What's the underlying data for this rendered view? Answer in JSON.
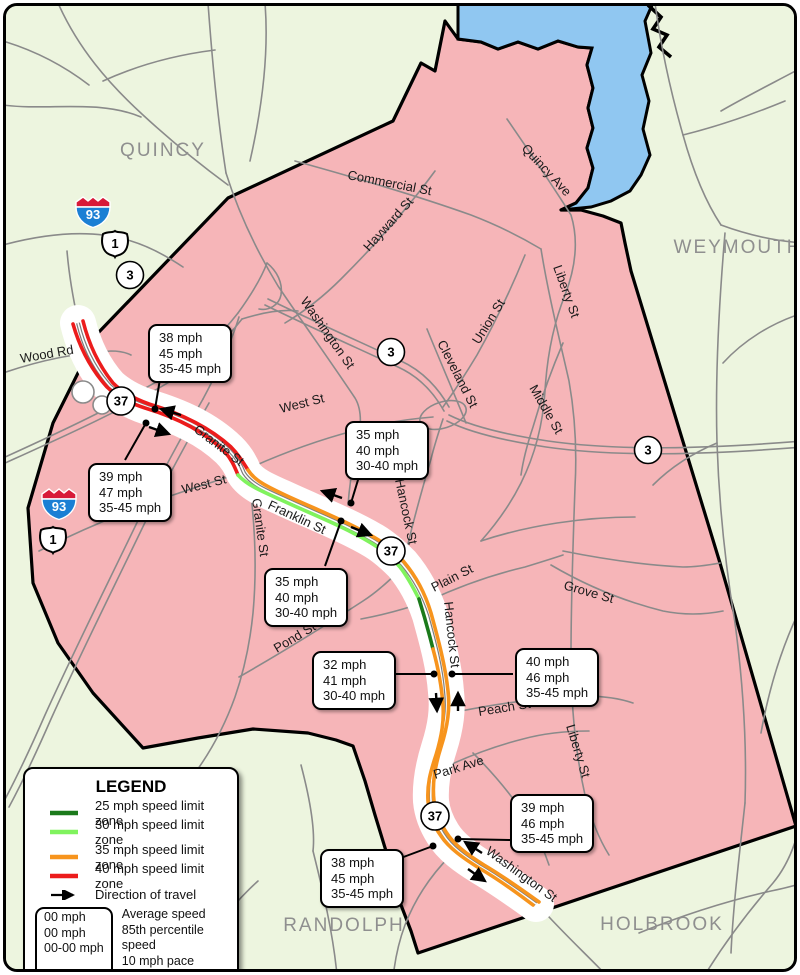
{
  "colors": {
    "zone25": "#1b7a1b",
    "zone30": "#80f35e",
    "zone35": "#f7941d",
    "zone40": "#ec1c1c",
    "town_fill": "#f6b5b8",
    "neighbor_fill": "#edf5df",
    "water": "#90c7f1",
    "road": "#8a8a8a",
    "town_label": "#8f8f8f"
  },
  "map": {
    "towns": {
      "quincy": "QUINCY",
      "weymouth": "WEYMOUTH",
      "randolph": "RANDOLPH",
      "holbrook": "HOLBROOK"
    },
    "shields": {
      "i93": "93",
      "us1": "1",
      "r3": "3",
      "r37": "37"
    },
    "streets": [
      {
        "label": "Wood Rd"
      },
      {
        "label": "Commercial St"
      },
      {
        "label": "Hayward St"
      },
      {
        "label": "Quincy Ave"
      },
      {
        "label": "Liberty St"
      },
      {
        "label": "Union St"
      },
      {
        "label": "Cleveland St"
      },
      {
        "label": "Washington St"
      },
      {
        "label": "Middle St"
      },
      {
        "label": "West St"
      },
      {
        "label": "Granite St"
      },
      {
        "label": "West St"
      },
      {
        "label": "Granite St"
      },
      {
        "label": "Franklin St"
      },
      {
        "label": "Hancock St"
      },
      {
        "label": "Plain St"
      },
      {
        "label": "Grove St"
      },
      {
        "label": "Pond St"
      },
      {
        "label": "Hancock St"
      },
      {
        "label": "Peach St"
      },
      {
        "label": "Park Ave"
      },
      {
        "label": "Liberty St"
      },
      {
        "label": "Washington St"
      }
    ],
    "callouts": [
      {
        "lines": [
          "38 mph",
          "45 mph",
          "35-45 mph"
        ]
      },
      {
        "lines": [
          "39 mph",
          "47 mph",
          "35-45 mph"
        ]
      },
      {
        "lines": [
          "35 mph",
          "40 mph",
          "30-40 mph"
        ]
      },
      {
        "lines": [
          "35 mph",
          "40 mph",
          "30-40 mph"
        ]
      },
      {
        "lines": [
          "32 mph",
          "41 mph",
          "30-40 mph"
        ]
      },
      {
        "lines": [
          "40 mph",
          "46 mph",
          "35-45 mph"
        ]
      },
      {
        "lines": [
          "39 mph",
          "46 mph",
          "35-45 mph"
        ]
      },
      {
        "lines": [
          "38 mph",
          "45 mph",
          "35-45 mph"
        ]
      }
    ]
  },
  "legend": {
    "title": "LEGEND",
    "zones": [
      {
        "label": "25 mph speed limit zone"
      },
      {
        "label": "30 mph speed limit zone"
      },
      {
        "label": "35 mph speed limit zone"
      },
      {
        "label": "40 mph speed limit zone"
      }
    ],
    "direction_label": "Direction of travel",
    "speed_box": {
      "rows": [
        {
          "value": "00 mph",
          "label": "Average speed"
        },
        {
          "value": "00 mph",
          "label": "85th percentile speed"
        },
        {
          "value": "00-00 mph",
          "label": "10 mph pace speed"
        }
      ]
    },
    "footnote": "mph = miles per hour"
  }
}
